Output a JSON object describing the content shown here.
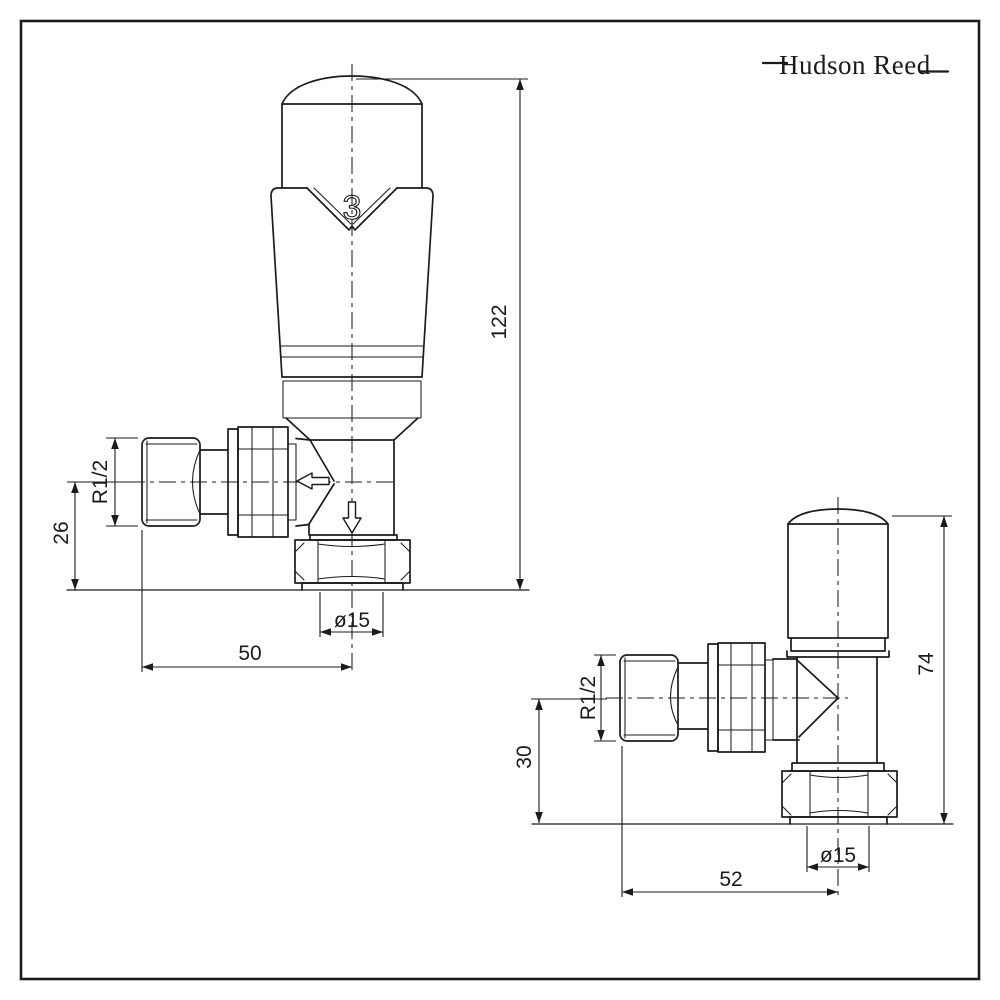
{
  "logo": {
    "text": "Hudson Reed"
  },
  "colors": {
    "line": "#1b1b1b",
    "background": "#ffffff"
  },
  "trv": {
    "setting_number": "3",
    "dim_height": "122",
    "dim_center_to_base": "26",
    "dim_depth": "50",
    "dim_thread": "R1/2",
    "dim_pipe_diameter": "ø15"
  },
  "lockshield": {
    "dim_height": "74",
    "dim_center_to_base": "30",
    "dim_depth": "52",
    "dim_thread": "R1/2",
    "dim_pipe_diameter": "ø15"
  }
}
